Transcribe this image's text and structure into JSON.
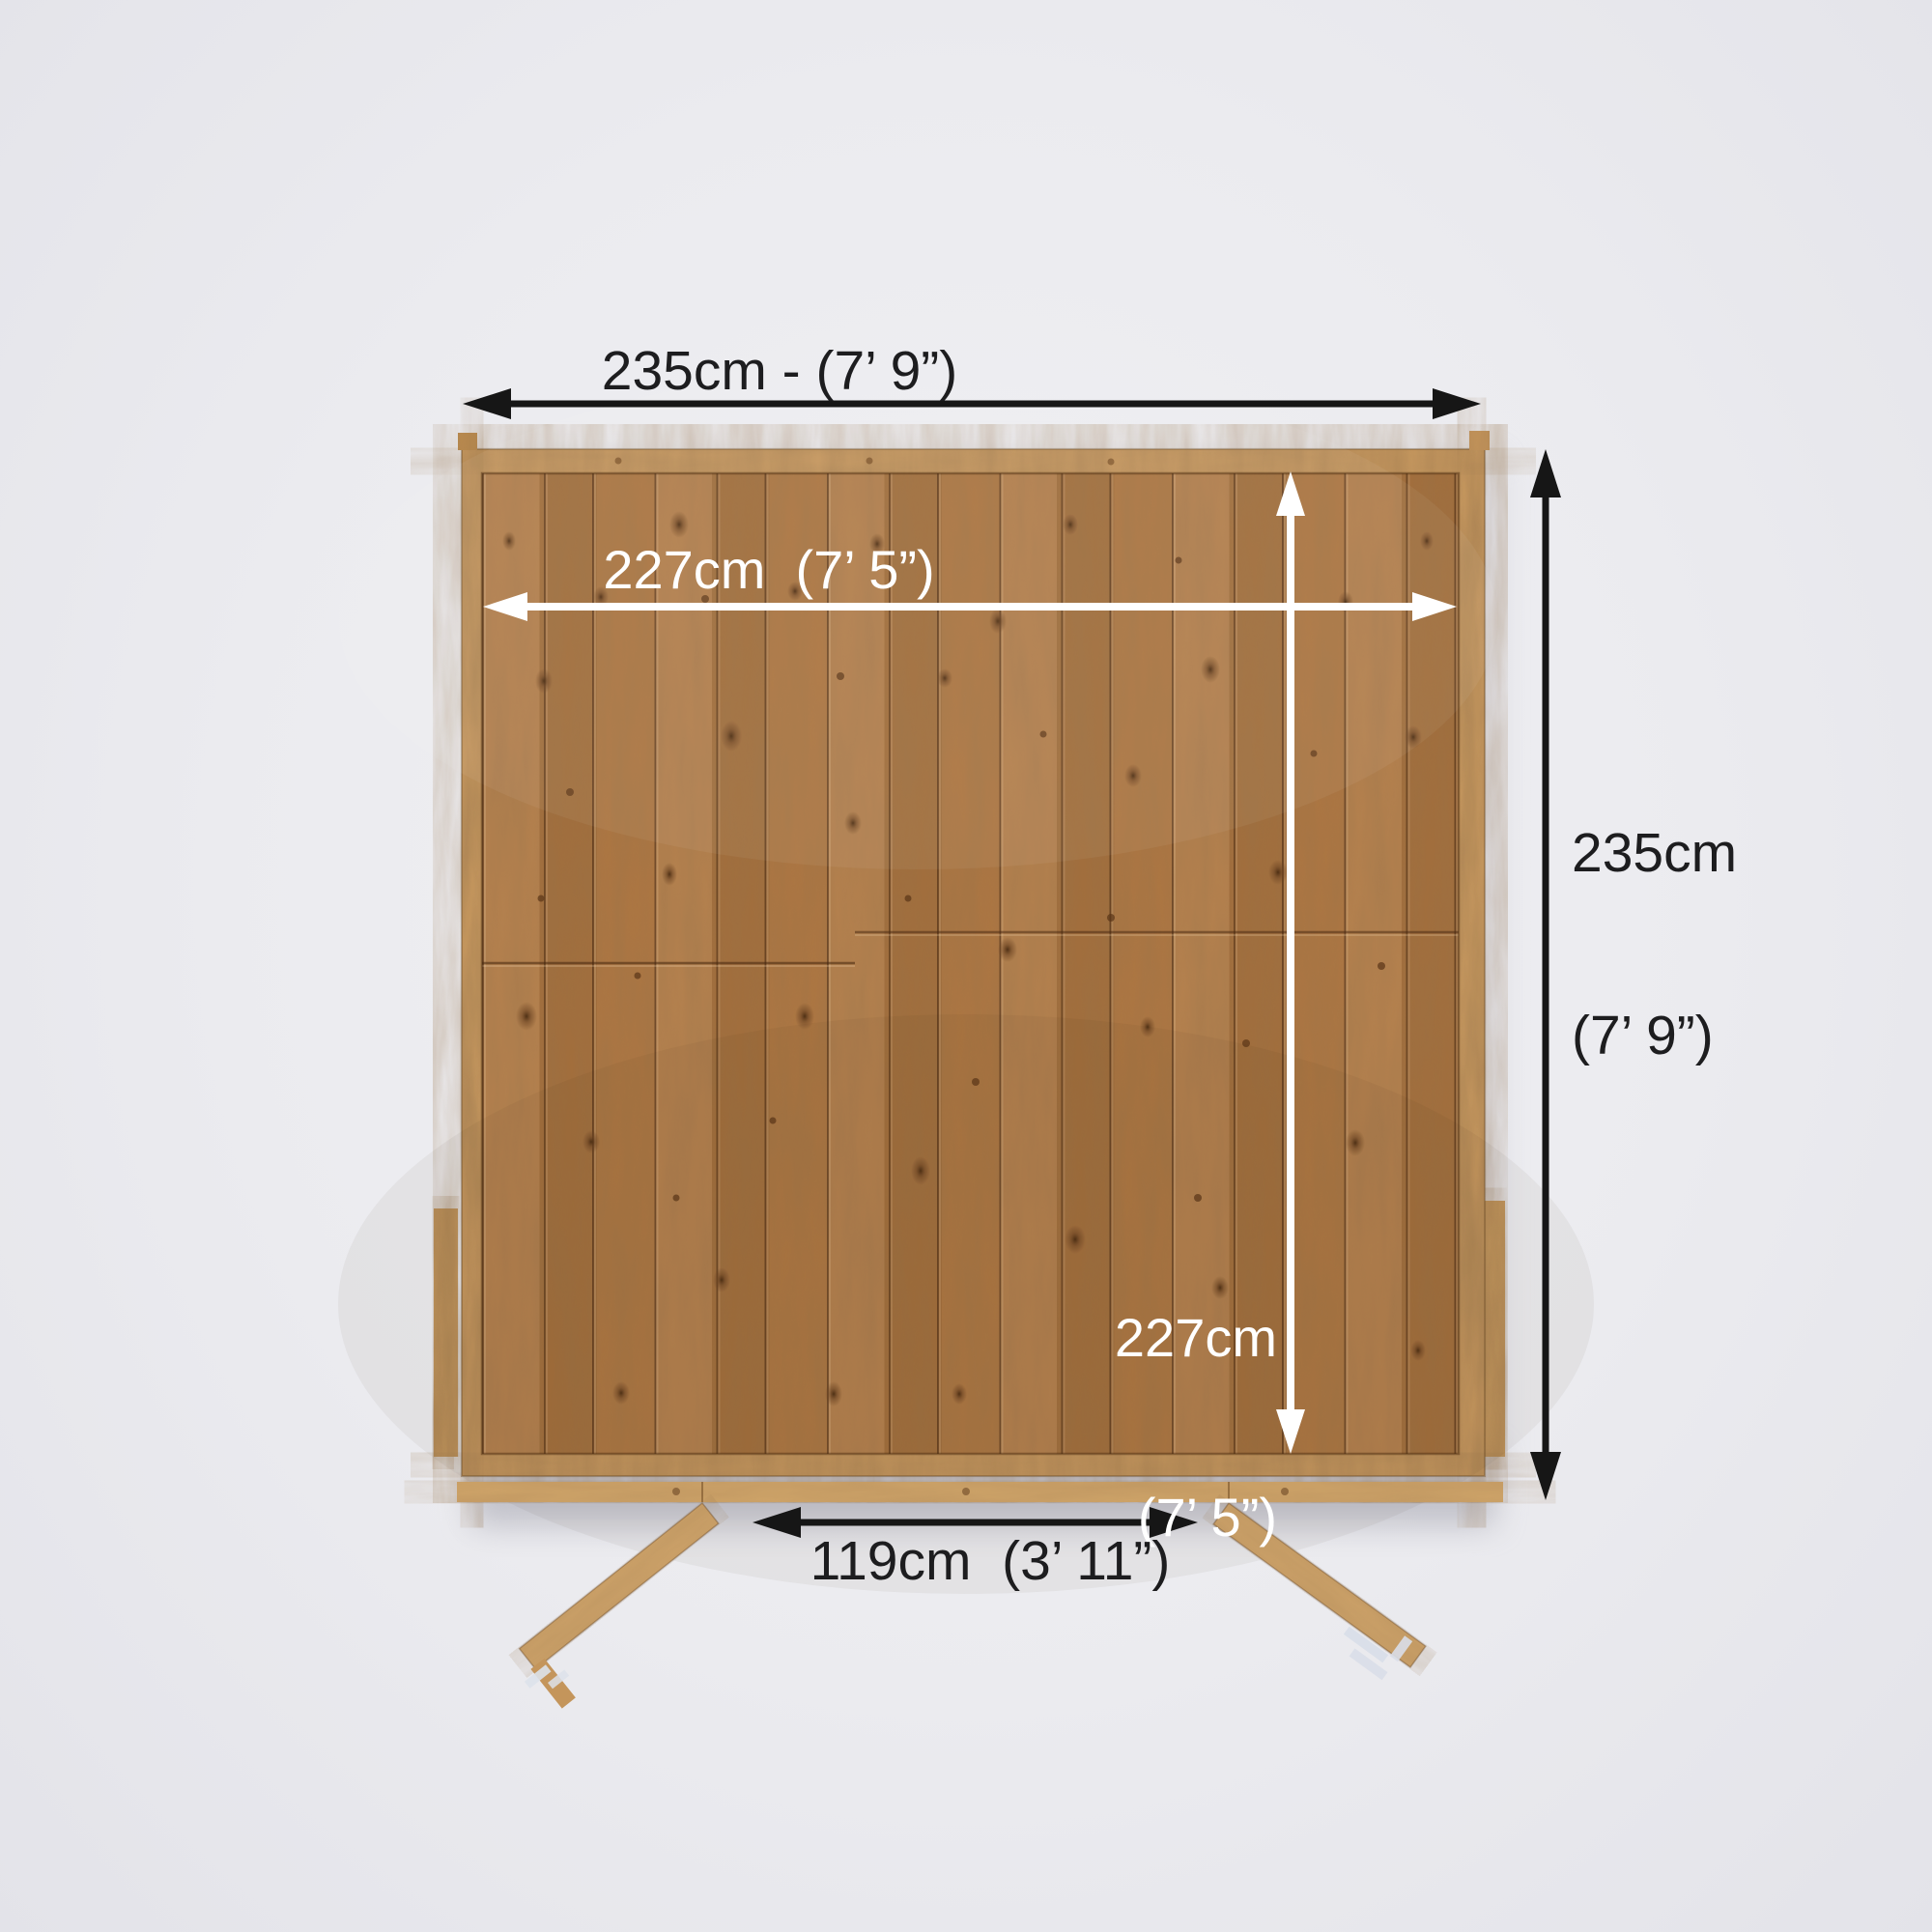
{
  "diagram": {
    "subject": "shed floor plan top-down dimension diagram",
    "labels": {
      "outer_width": "235cm - (7’ 9”)",
      "outer_depth_line1": "235cm",
      "outer_depth_line2": "(7’ 9”)",
      "inner_width": "227cm  (7’ 5”)",
      "inner_depth_line1": "227cm",
      "inner_depth_line2": "(7’ 5”)",
      "door_width": "119cm  (3’ 11”)"
    },
    "colors": {
      "background": "#ebebef",
      "outer_arrow": "#161616",
      "inner_arrow": "#ffffff",
      "outer_label_text": "#1d1d1f",
      "inner_label_text": "#ffffff",
      "wood_frame": "#c99a60",
      "wood_floor": "#ad7642",
      "wood_sill": "#cfa469"
    }
  }
}
